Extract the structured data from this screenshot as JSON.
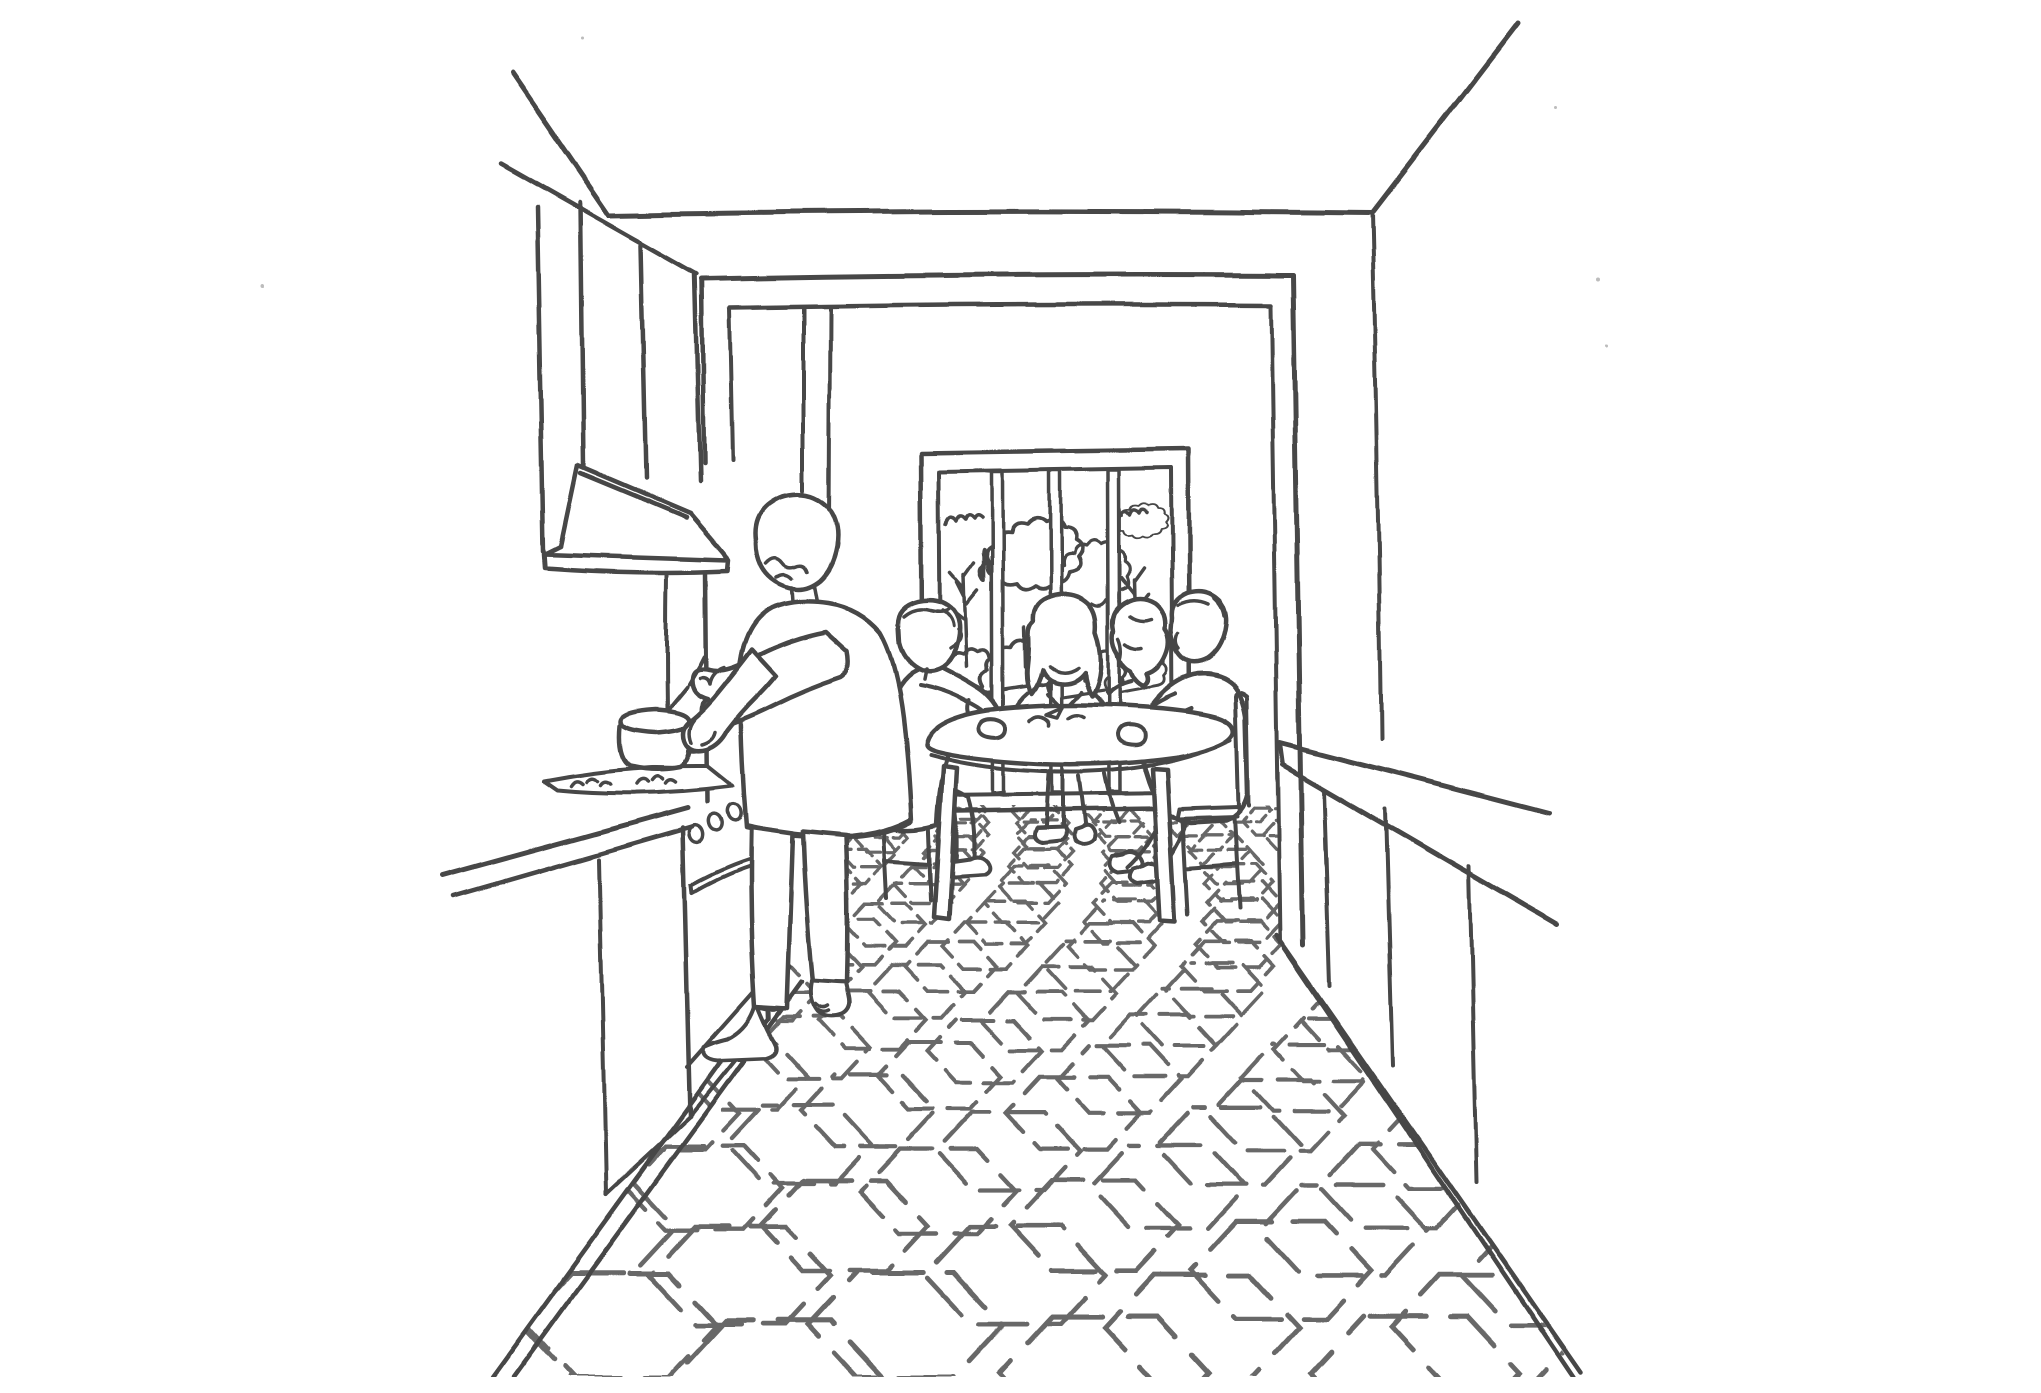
{
  "title": "Kitchen interior line drawing",
  "colors": {
    "ink": "#474747",
    "paper": "#ffffff"
  },
  "scene": {
    "labels": {
      "drawing": "Hand-drawn ink sketch of a galley kitchen opening onto a dining room",
      "ceiling": "Ceiling edges",
      "wall_cabinet": "Wall cabinet above the stove",
      "range_hood": "Range hood with flue",
      "pot": "Pot on the stove with stirring spoon",
      "hob": "Gas hob with two burners",
      "counter_left": "Left counter with oven and cabinets",
      "oven": "Oven with three knobs and a handle",
      "cook": "Person standing at the stove stirring a pot",
      "doorway": "Wide doorway to the dining room",
      "window": "Dining room window with four panes",
      "trees": "Trees and bushes outside the window",
      "dining_table": "Round dining table",
      "diners": "Four people seated around the table",
      "bench": "Bench at the left of the table",
      "chair": "Chair at the right of the table",
      "counter_right": "Long counter along the right wall",
      "floor": "Hexagonal tile floor",
      "specks": "Stray paper specks"
    },
    "counts": {
      "diners": 4,
      "window_panes": 4,
      "oven_knobs": 3,
      "burners": 2
    }
  },
  "floor": {
    "vp_y": 630,
    "y_start": 794,
    "y_end": 1400,
    "scale": 0.155,
    "width_ratio": 1.85,
    "x_min": 430,
    "x_max": 1640,
    "stroke_opacity": 0.82,
    "clip": [
      [
        788,
        790
      ],
      [
        1240,
        790
      ],
      [
        1240,
        921
      ],
      [
        1540,
        1361
      ],
      [
        452,
        1361
      ],
      [
        750,
        950
      ],
      [
        788,
        922
      ]
    ]
  }
}
